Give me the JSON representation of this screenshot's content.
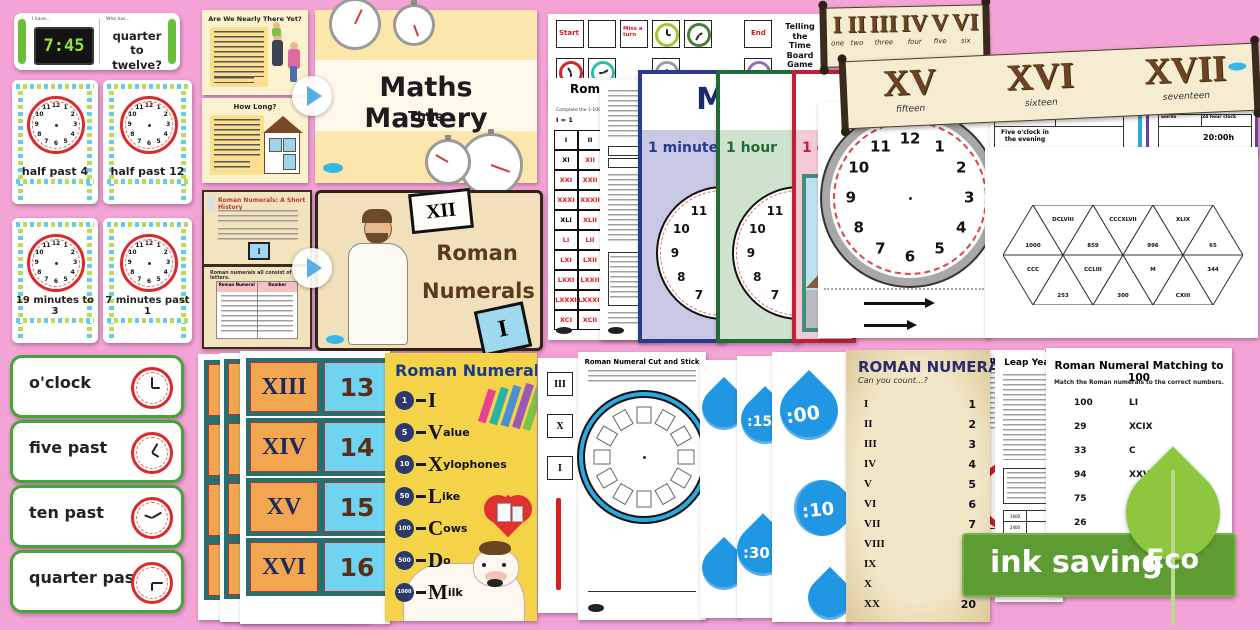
{
  "colors": {
    "background": "#f4a3d6",
    "accent_green": "#44a636",
    "clock_red": "#d92b2b",
    "eco_green": "#5d9c33",
    "leaf_green": "#8dc63f",
    "drop_blue": "#2196e3",
    "banner_brown": "#6b4423"
  },
  "shared": {
    "dial": [
      "12",
      "1",
      "2",
      "3",
      "4",
      "5",
      "6",
      "7",
      "8",
      "9",
      "10",
      "11"
    ]
  },
  "loop_card": {
    "i_have": "I have...",
    "who_has": "Who has...",
    "time": "7:45",
    "question": "quarter to twelve?"
  },
  "flashcards": {
    "items": [
      {
        "caption": "half past 4"
      },
      {
        "caption": "half past 12"
      },
      {
        "caption": "19 minutes to 3"
      },
      {
        "caption": "7 minutes past 1"
      }
    ]
  },
  "word_cards": {
    "items": [
      {
        "label": "o'clock"
      },
      {
        "label": "five past"
      },
      {
        "label": "ten past"
      },
      {
        "label": "quarter past"
      }
    ]
  },
  "maths_pres": {
    "title": "Maths Mastery",
    "subtitle": "Time",
    "slide1_title": "Are We Nearly There Yet?",
    "slide2_title": "How Long?"
  },
  "roman_pres": {
    "word1": "Roman",
    "word2": "Numerals",
    "tile_top": "XII",
    "tile_bottom": "I",
    "slide1_title": "Roman Numerals: A Short History",
    "slide2_heading": "Roman numerals all consist of 7 letters.",
    "col1": "Roman Numeral",
    "col2": "Number"
  },
  "board_game": {
    "title1": "Telling the",
    "title2": "Time Board",
    "title3": "Game",
    "question": "What time is it?",
    "start": "Start",
    "miss_a_turn": "Miss a turn",
    "end": "End"
  },
  "grid_sheet": {
    "title": "Roman Numerals",
    "intro": "Complete the 1-100 square.",
    "key": "I = 1",
    "cells": [
      "I",
      "II",
      "XI",
      "XII",
      "XXI",
      "XXII",
      "XXXI",
      "XXXII",
      "XLI",
      "XLII",
      "LI",
      "LII",
      "LXI",
      "LXII",
      "LXXI",
      "LXXII",
      "LXXXI",
      "LXXXII",
      "XCI",
      "XCII"
    ]
  },
  "posters": {
    "top_letter": "M",
    "minute": "1 minute",
    "hour": "1 hour",
    "day": "1 day"
  },
  "banners": {
    "b1": {
      "numerals": [
        "I",
        "II",
        "III",
        "IV",
        "V",
        "VI"
      ],
      "words": [
        "one",
        "two",
        "three",
        "four",
        "five",
        "six"
      ]
    },
    "b2": {
      "numerals": [
        "XV",
        "XVI",
        "XVII"
      ],
      "words": [
        "fifteen",
        "sixteen",
        "seventeen"
      ]
    }
  },
  "time_tables": {
    "col_words": "words",
    "col_24": "24 hour clock",
    "value_left": "Five o'clock in the evening",
    "value_right": "20:00h"
  },
  "tarsia": {
    "labels": [
      "1000",
      "DCLVIII",
      "859",
      "CCCXLVII",
      "996",
      "XLIX",
      "65",
      "CCC",
      "253",
      "CCLIII",
      "300",
      "M",
      "CXIII",
      "344"
    ]
  },
  "match_cards": {
    "roman": [
      "XIII",
      "XIV",
      "XV",
      "XVI"
    ],
    "nums": [
      "13",
      "14",
      "15",
      "16"
    ]
  },
  "mnemonic": {
    "title": "Roman Numerals",
    "rows": [
      {
        "n": "1",
        "l": "I",
        "w": ""
      },
      {
        "n": "5",
        "l": "V",
        "w": "alue"
      },
      {
        "n": "10",
        "l": "X",
        "w": "ylophones"
      },
      {
        "n": "50",
        "l": "L",
        "w": "ike"
      },
      {
        "n": "100",
        "l": "C",
        "w": "ows"
      },
      {
        "n": "500",
        "l": "D",
        "w": "o"
      },
      {
        "n": "1000",
        "l": "M",
        "w": "ilk"
      }
    ]
  },
  "cut_stick": {
    "title": "Roman Numeral Cut and Stick",
    "tiles": [
      "III",
      "X",
      "I"
    ]
  },
  "raindrops": {
    "t1": ":00",
    "t2": ":10",
    "t3": ":30",
    "t4": ":15"
  },
  "roman_count": {
    "title": "ROMAN NUMERALS",
    "subtitle": "Can you count...?",
    "rows": [
      [
        "I",
        "1"
      ],
      [
        "II",
        "2"
      ],
      [
        "III",
        "3"
      ],
      [
        "IV",
        "4"
      ],
      [
        "V",
        "5"
      ],
      [
        "VI",
        "6"
      ],
      [
        "VII",
        "7"
      ],
      [
        "VIII",
        "8"
      ],
      [
        "IX",
        "9"
      ],
      [
        "X",
        "10"
      ],
      [
        "XX",
        "20"
      ]
    ]
  },
  "time_sheet": {
    "title": "Time"
  },
  "leap_year": {
    "title": "Leap Year",
    "years": [
      "1600",
      "2400",
      "1700"
    ]
  },
  "matching100": {
    "title": "Roman Numeral Matching to 100",
    "instr": "Match the Roman numerals to the correct numbers.",
    "numbers": [
      "100",
      "29",
      "33",
      "94",
      "75",
      "26",
      "51",
      "48"
    ],
    "numerals": [
      "LI",
      "XCIX",
      "C",
      "XXVI",
      "LXVIII",
      "XLVIII",
      "XXIX",
      "XXX"
    ]
  },
  "eco": {
    "label": "ink saving",
    "badge": "Eco"
  }
}
